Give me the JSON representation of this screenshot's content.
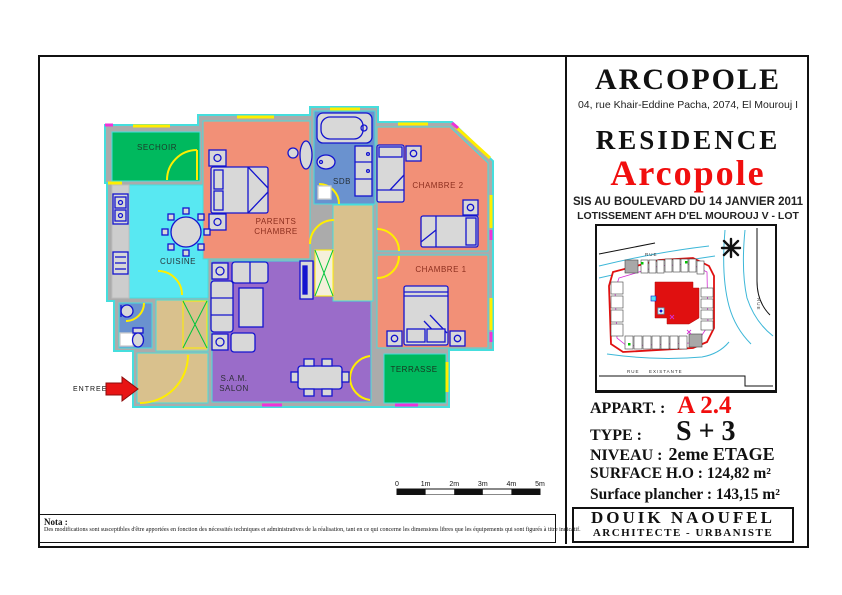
{
  "title_block": {
    "brand": "ARCOPOLE",
    "address": "04, rue Khair-Eddine Pacha, 2074, El Mourouj I",
    "residence_label": "RESIDENCE",
    "residence_name": "Arcopole",
    "sis_line": "SIS AU BOULEVARD DU 14 JANVIER 2011",
    "lot_line": "LOTISSEMENT AFH D'EL MOUROUJ V - LOT EHC 30",
    "appart_label": "APPART. :",
    "appart_value": "A 2.4",
    "type_label": "TYPE :",
    "type_value": "S + 3",
    "niveau_label": "NIVEAU :",
    "niveau_value": "2eme ETAGE",
    "surface_label": "SURFACE H.O :",
    "surface_value": "124,82 m²",
    "plancher_label": "Surface plancher :",
    "plancher_value": "143,15 m²",
    "architect_name": "DOUIK NAOUFEL",
    "architect_title": "ARCHITECTE - URBANISTE"
  },
  "site_plan": {
    "rue_top": "RUE",
    "rue_right": "RUE",
    "rue_bottom_1": "RUE",
    "rue_bottom_2": "EXISTANTE"
  },
  "floor_plan": {
    "rooms": {
      "sechoir": "SECHOIR",
      "cuisine": "CUISINE",
      "parents_1": "PARENTS",
      "parents_2": "CHAMBRE",
      "sdb": "SDB",
      "chambre2": "CHAMBRE 2",
      "chambre1": "CHAMBRE 1",
      "terrasse": "TERRASSE",
      "sam_1": "S.A.M.",
      "sam_2": "SALON"
    },
    "entree": "ENTREE"
  },
  "scale_bar": {
    "ticks": [
      "0",
      "1m",
      "2m",
      "3m",
      "4m",
      "5m"
    ]
  },
  "nota": {
    "label": "Nota :",
    "text": "Des modifications sont susceptibles d'être apportées en fonction des nécessités techniques et administratives de la réalisation, tant en ce qui concerne les dimensions libres que les équipements qui sont figurés à titre indicatif."
  },
  "colors": {
    "accent_red": "#f10e0e",
    "room_green": "#00b95e",
    "room_cyan": "#58e8f2",
    "room_salmon": "#f29077",
    "room_blue": "#6a92cf",
    "room_purple": "#9a6cc9",
    "hall_tan": "#d9c18d",
    "wall_gray": "#ababab",
    "furniture_blue": "#1414cf",
    "outline_cyan": "#45dedd",
    "door_yellow": "#ffee00",
    "window_magenta": "#f032d8"
  }
}
